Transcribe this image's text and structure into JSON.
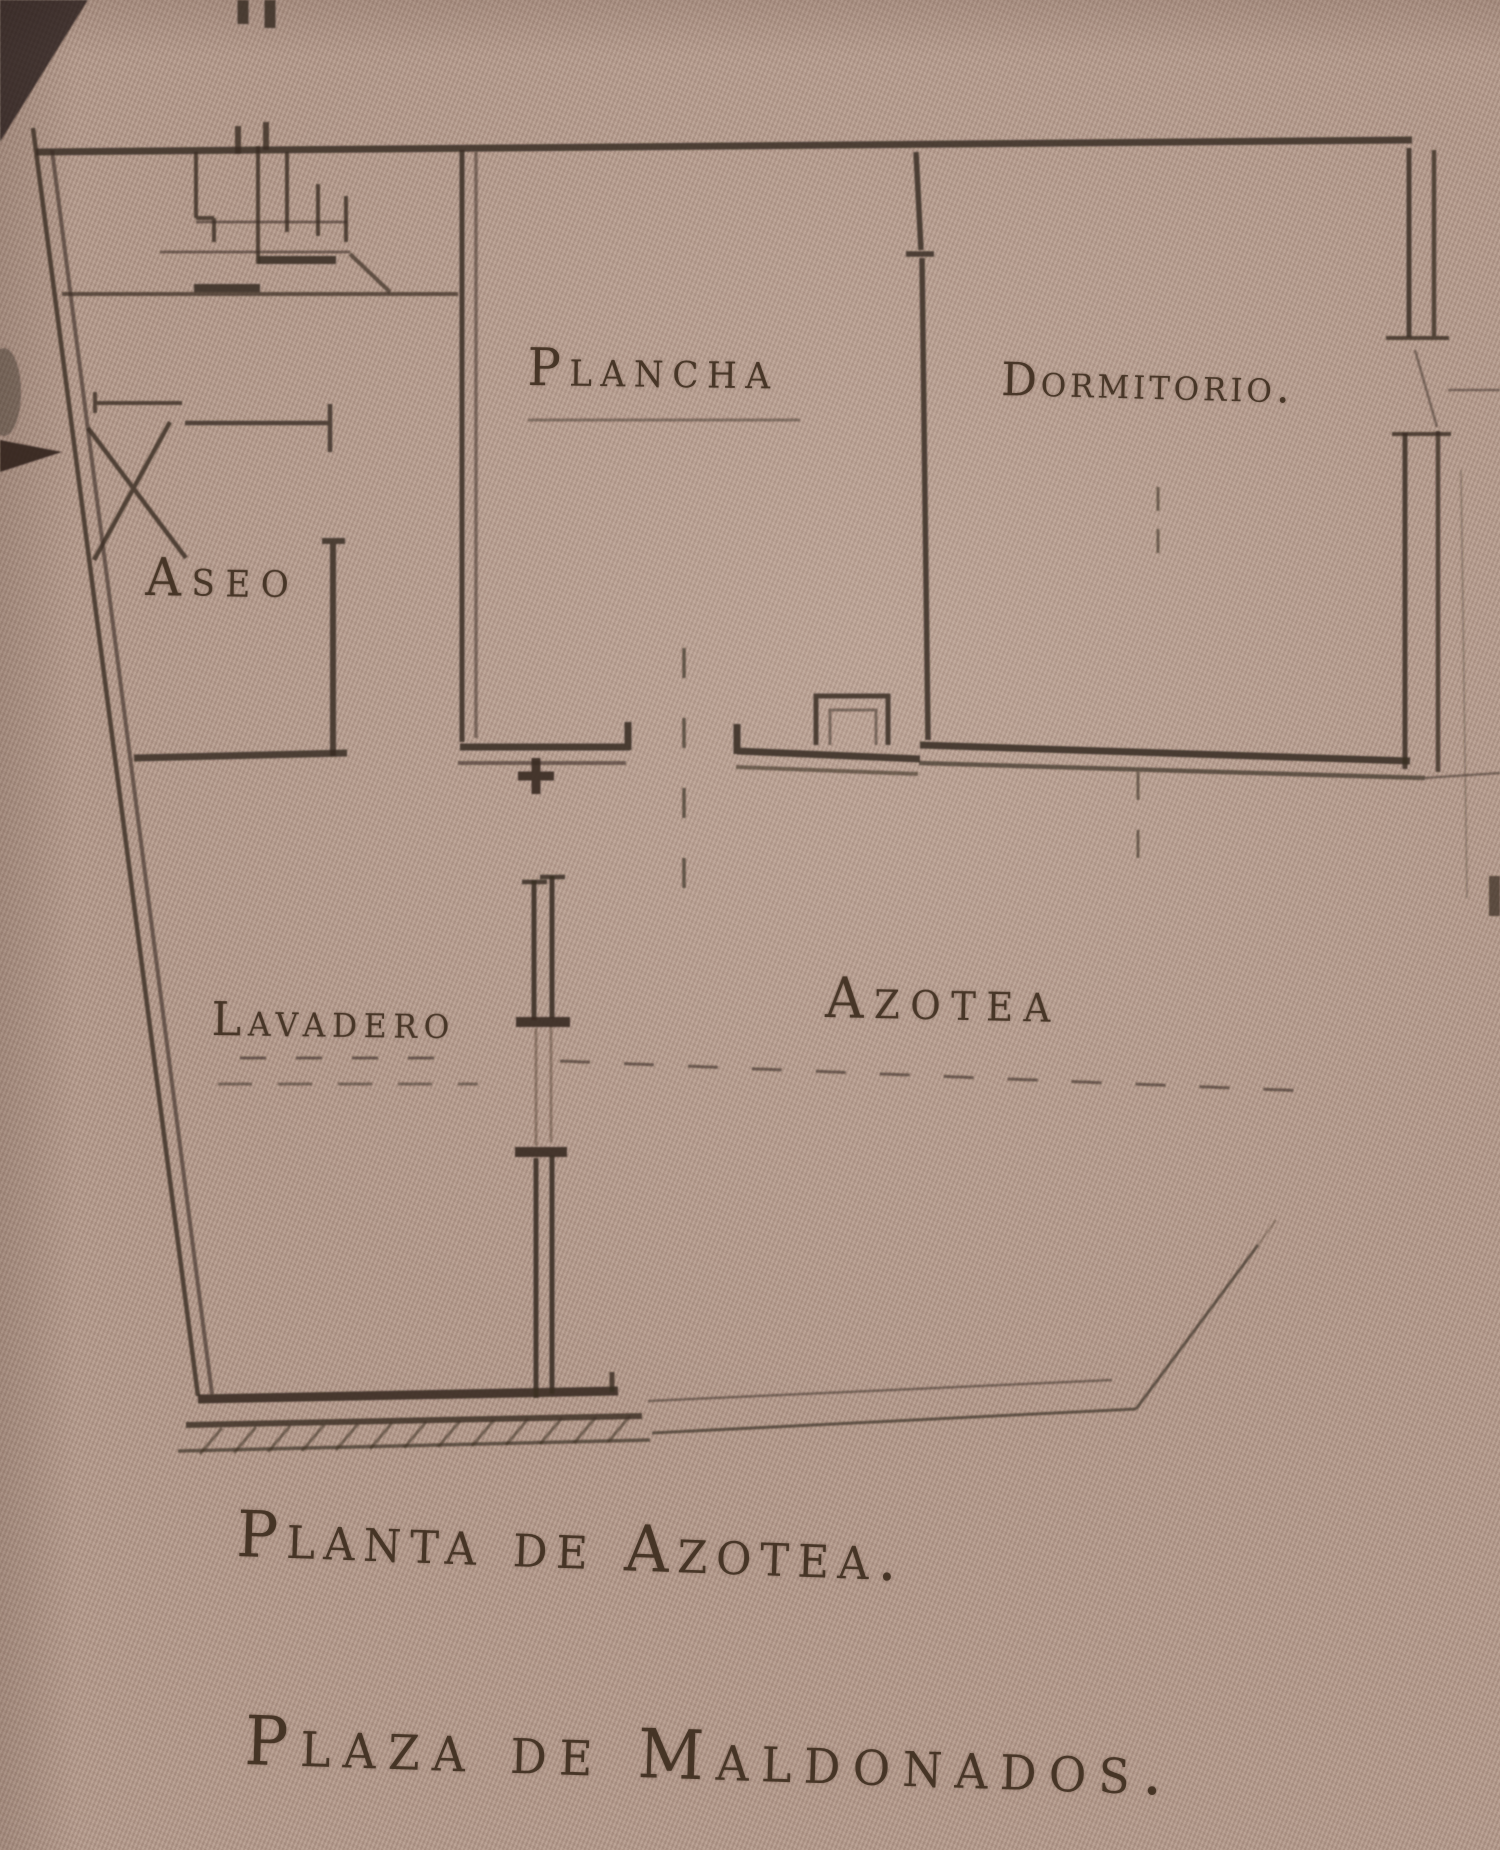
{
  "photo": {
    "description": "Aged hand-drawn architectural roof plan on textured paper",
    "colors": {
      "paper": "#b39a8d",
      "ink": "#3a2d23"
    }
  },
  "plan": {
    "rooms": [
      {
        "name": "plancha",
        "label": "Plancha"
      },
      {
        "name": "dormitorio",
        "label": "Dormitorio."
      },
      {
        "name": "aseo",
        "label": "Aseo"
      },
      {
        "name": "lavadero",
        "label": "Lavadero"
      },
      {
        "name": "azotea",
        "label": "Azotea"
      }
    ],
    "captions": {
      "title": "Planta de Azotea.",
      "subtitle": "Plaza de Maldonados."
    }
  }
}
